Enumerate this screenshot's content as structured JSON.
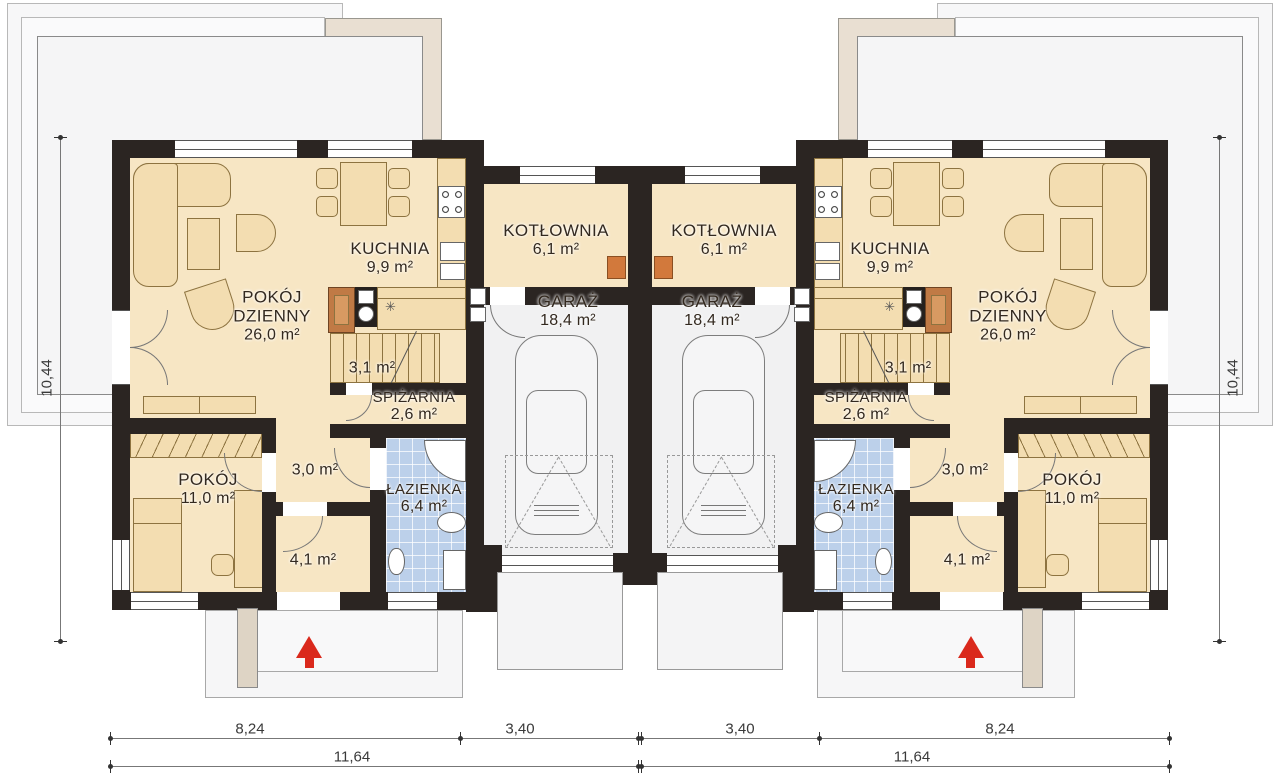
{
  "plan_type": "twin-house-ground-floor-plan",
  "colors": {
    "wall": "#2b2522",
    "room_cream": "#f7e6c4",
    "furniture": "#f3ddb1",
    "bathroom_tile": "#bcd0ea",
    "garage_floor": "#f1f1f2",
    "chimney_wood": "#c07a45",
    "boiler_orange": "#d2793c",
    "entrance_arrow_red": "#da291c",
    "roof_beige": "#e9dfd2"
  },
  "rooms": [
    {
      "name": "POKÓJ",
      "name2": "DZIENNY",
      "area": "26,0 m²"
    },
    {
      "name": "KUCHNIA",
      "area": "9,9 m²"
    },
    {
      "name": "KOTŁOWNIA",
      "area": "6,1 m²"
    },
    {
      "name": "GARAŻ",
      "area": "18,4 m²"
    },
    {
      "name": "",
      "area": "3,1 m²"
    },
    {
      "name": "SPIŻARNIA",
      "area": "2,6 m²"
    },
    {
      "name": "",
      "area": "3,0 m²"
    },
    {
      "name": "ŁAZIENKA",
      "area": "6,4 m²"
    },
    {
      "name": "",
      "area": "4,1 m²"
    },
    {
      "name": "POKÓJ",
      "area": "11,0 m²"
    }
  ],
  "dimensions": {
    "bottom_left": [
      "8,24",
      "3,40"
    ],
    "bottom_right": [
      "3,40",
      "8,24"
    ],
    "total_left": "11,64",
    "total_right": "11,64",
    "side_left": "10,44",
    "side_right": "10,44"
  },
  "icons": {
    "vent": "✳"
  }
}
